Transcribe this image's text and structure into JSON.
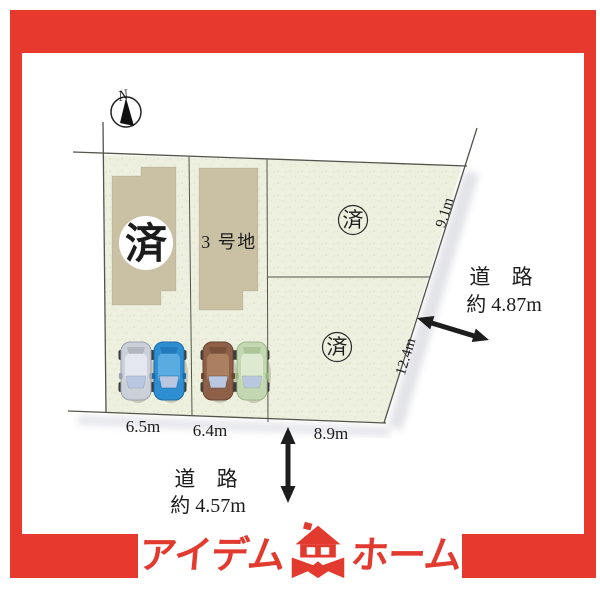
{
  "colors": {
    "frame_red": "#e8392f",
    "logo_red": "#e23a2e",
    "plot_fill": "#eef0df",
    "building_fill": "#cac1a5",
    "line": "#54544c",
    "text": "#1c1c1c"
  },
  "compass": {
    "north_label": "N"
  },
  "diagram": {
    "parcel_left": {
      "status": "済"
    },
    "parcel_middle": {
      "name": "3 号地"
    },
    "parcel_right_top": {
      "status": "済"
    },
    "parcel_right_bottom": {
      "status": "済"
    },
    "measurements": {
      "left_frontage": "6.5m",
      "middle_frontage": "6.4m",
      "right_frontage": "8.9m",
      "right_edge_upper": "9.1m",
      "right_edge_lower": "12.4m"
    },
    "road_right": {
      "title": "道 路",
      "width": "約 4.87m"
    },
    "road_bottom": {
      "title": "道 路",
      "width": "約 4.57m"
    },
    "cars": [
      {
        "name": "car-silver",
        "body": "#ccd0d8",
        "light": "#e4e7ed",
        "shade": "#9aa0ac"
      },
      {
        "name": "car-blue",
        "body": "#2f8ed2",
        "light": "#5aabdf",
        "shade": "#1c6aa8"
      },
      {
        "name": "car-brown",
        "body": "#8d6047",
        "light": "#aa8060",
        "shade": "#6b4530"
      },
      {
        "name": "car-green",
        "body": "#c3d8b2",
        "light": "#ddead1",
        "shade": "#9ab585"
      }
    ]
  },
  "logo": {
    "name_left": "アイデム",
    "name_right": "ホーム"
  }
}
